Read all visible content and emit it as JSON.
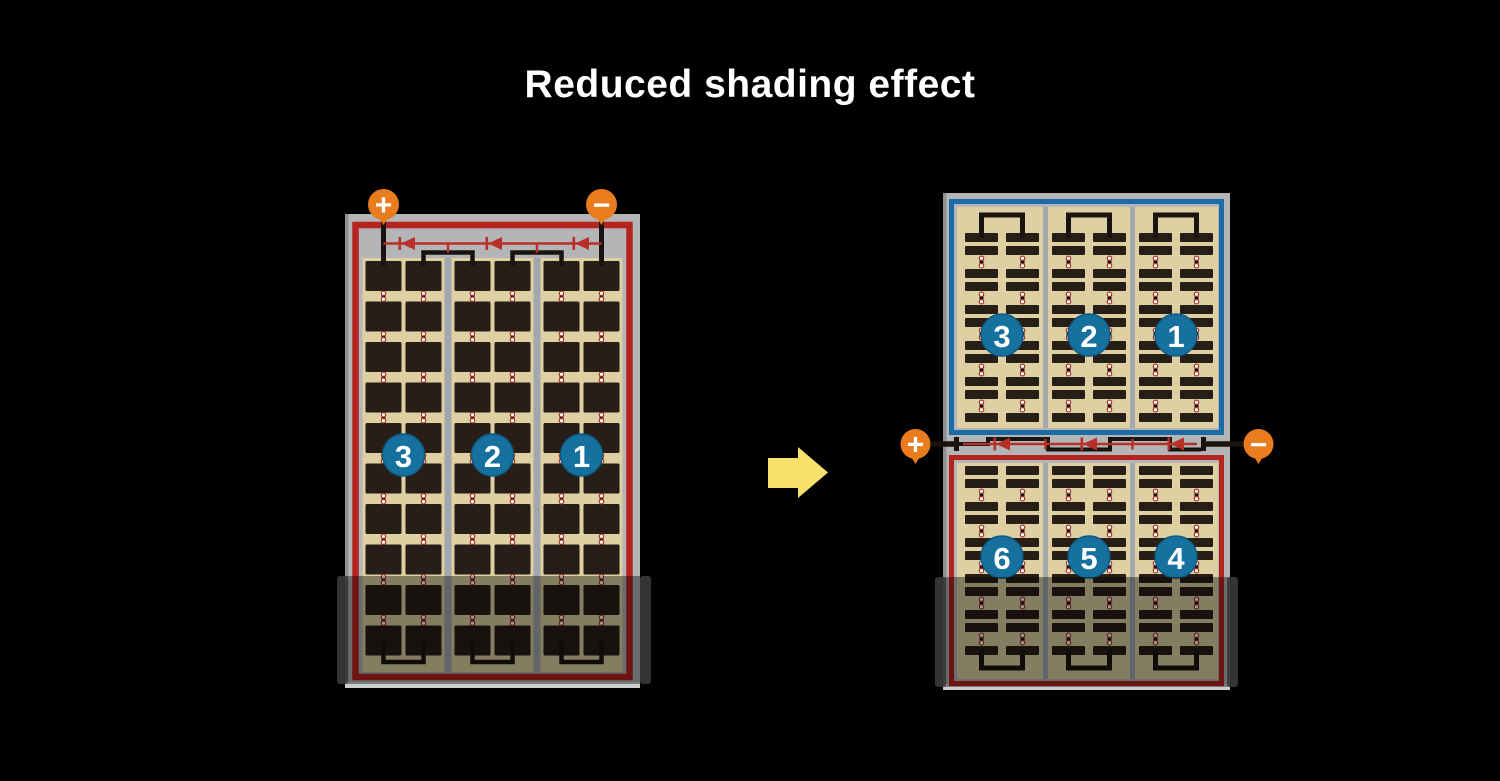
{
  "title": "Reduced shading effect",
  "colors": {
    "background": "#000000",
    "frame_gray": "#b3b5b7",
    "frame_edge_dark": "#8e9092",
    "frame_edge_light": "#cccdce",
    "cell_field_tan": "#ded0a2",
    "cell_dark": "#271e18",
    "divider_gray": "#a2a7ae",
    "red_border": "#b5241f",
    "diode_red": "#b93029",
    "blue_border": "#1d6ba6",
    "badge_blue": "#16719f",
    "badge_ring": "#0d5a83",
    "terminal_orange": "#e87c1e",
    "arrow_yellow": "#f8e26b",
    "wire_black": "#1a1410",
    "connector_dot_ring": "#a83226",
    "shade_overlay": "rgba(0,0,0,0.40)",
    "shade_cap": "#3a3a3a"
  },
  "left_panel": {
    "plus_label": "+",
    "minus_label": "−",
    "bypass_diodes": 3,
    "cell_columns": 6,
    "cell_rows": 10,
    "sections": [
      {
        "number": "3"
      },
      {
        "number": "2"
      },
      {
        "number": "1"
      }
    ],
    "shaded_bottom": true
  },
  "right_panel": {
    "plus_label": "+",
    "minus_label": "−",
    "bypass_diodes": 3,
    "top_sections": [
      {
        "number": "3"
      },
      {
        "number": "2"
      },
      {
        "number": "1"
      }
    ],
    "bottom_sections": [
      {
        "number": "6"
      },
      {
        "number": "5"
      },
      {
        "number": "4"
      }
    ],
    "shaded_bottom": true
  }
}
